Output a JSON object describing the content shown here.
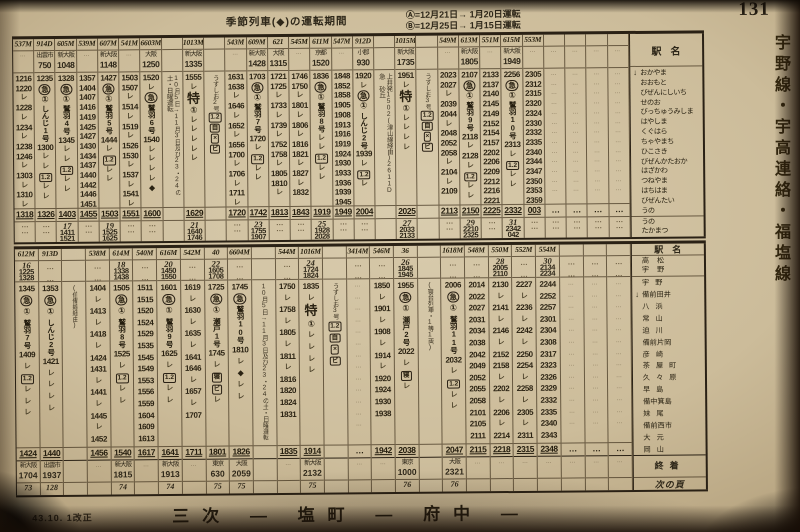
{
  "page": {
    "number": "131",
    "revision": "43.10. 1改正",
    "footer_title": "三次 ― 塩町 ― 府中 ―",
    "next_page_label": "次の頁",
    "side_tab": "宇野線・宇高連絡・福塩線"
  },
  "header": {
    "title": "季節列車(◆)の運転期間",
    "note_a": "Ⓐ=12月21日→ 1月20日運転",
    "note_b": "Ⓑ=12月25日→ 1月15日運転"
  },
  "station_label": "駅名",
  "terminal_label": "終着",
  "top_table": {
    "stations": [
      "おかやま",
      "おおもと",
      "びぜんにしいち",
      "せのお",
      "びっちゅうみしま",
      "はやしま",
      "くぐはら",
      "ちゃやまち",
      "ひこさき",
      "びぜんかたおか",
      "はざかわ",
      "つねやま",
      "はちはま",
      "びぜんたい",
      "うの"
    ],
    "ferry_stations": [
      "うの",
      "たかまつ"
    ],
    "columns": [
      {
        "no": "537M",
        "cells": [
          "1216",
          "1220",
          "L",
          "1228",
          "L",
          "1234",
          "L",
          "1238",
          "1246",
          "L",
          "1303",
          "L",
          "1310",
          "L"
        ],
        "arr": "1318"
      },
      {
        "no": "914D",
        "origin": {
          "st": "出雲市",
          "t": "750"
        },
        "cells": [
          "1235",
          "E",
          "R1",
          "N:しんじ1号",
          "1300",
          "L",
          "L",
          "G",
          "L",
          "L"
        ],
        "arr": "1326"
      },
      {
        "no": "605M",
        "origin": {
          "st": "新大阪",
          "t": "1048"
        },
        "cells": [
          "1328",
          "E",
          "R1",
          "N:鷲羽4号",
          "1345",
          "L",
          "L",
          "G",
          "L",
          "L"
        ],
        "arr": "1403",
        "ferry": {
          "no": "17",
          "dep": "1411",
          "arr": "1521"
        }
      },
      {
        "no": "539M",
        "cells": [
          "1357",
          "1404",
          "1407",
          "1416",
          "1419",
          "1425",
          "1427",
          "1430",
          "1434",
          "1437",
          "1440",
          "1442",
          "1446",
          "1451"
        ],
        "arr": "1455"
      },
      {
        "no": "607M",
        "origin": {
          "st": "新大阪",
          "t": "1148"
        },
        "cells": [
          "1427",
          "E",
          "R1",
          "N:鷲羽5号",
          "1444",
          "L",
          "G",
          "L",
          "L"
        ],
        "arr": "1503",
        "ferry": {
          "no": "19",
          "dep": "1525",
          "arr": "1625"
        }
      },
      {
        "no": "541M",
        "cells": [
          "1503",
          "1507",
          "L",
          "1514",
          "L",
          "1519",
          "L",
          "1526",
          "1530",
          "L",
          "1537",
          "L",
          "1541",
          "L"
        ],
        "arr": "1551"
      },
      {
        "no": "6603M",
        "origin": {
          "st": "大阪",
          "t": "1250"
        },
        "cells": [
          "1520",
          "L",
          "E",
          "N:鷲羽6号",
          "1540",
          "L",
          "L",
          "L",
          "L",
          "D"
        ],
        "arr": "1600"
      },
      {
        "note": "10月5日→11月3日及び23・24の土・日曜運転"
      },
      {
        "no": "1013M",
        "origin": {
          "st": "新大阪",
          "t": "1335"
        },
        "cells": [
          "1555",
          "L",
          "EX",
          "R1",
          "L",
          "L",
          "L",
          "L",
          "L"
        ],
        "arr": "1629",
        "ferry": {
          "no": "21",
          "dep": "1640",
          "arr": "1746"
        }
      },
      {
        "note": "うずしお2号",
        "syms": [
          "G",
          "J",
          "X",
          "B"
        ]
      },
      {
        "no": "543M",
        "cells": [
          "1631",
          "1638",
          "L",
          "1646",
          "L",
          "1652",
          "L",
          "1656",
          "1700",
          "L",
          "1706",
          "L",
          "1711",
          "L"
        ],
        "arr": "1720"
      },
      {
        "no": "609M",
        "origin": {
          "st": "新大阪",
          "t": "1428"
        },
        "cells": [
          "1703",
          "E",
          "R1",
          "N:鷲羽7号",
          "1720",
          "L",
          "G",
          "L",
          "L"
        ],
        "arr": "1742",
        "ferry": {
          "no": "23",
          "dep": "1755",
          "arr": "1907"
        }
      },
      {
        "no": "621",
        "origin": {
          "st": "大阪",
          "t": "1315"
        },
        "cells": [
          "1721",
          "1725",
          "L",
          "1733",
          "L",
          "1739",
          "L",
          "1752",
          "1758",
          "L",
          "1805",
          "1810",
          "L"
        ],
        "arr": "1813"
      },
      {
        "no": "545M",
        "cells": [
          "1746",
          "1750",
          "L",
          "1801",
          "L",
          "1806",
          "L",
          "1816",
          "1821",
          "L",
          "1827",
          "L",
          "1832"
        ],
        "arr": "1843"
      },
      {
        "no": "611M",
        "origin": {
          "st": "京都",
          "t": "1520"
        },
        "cells": [
          "1836",
          "E",
          "R1",
          "N:鷲羽8号",
          "L",
          "L",
          "G",
          "L",
          "L"
        ],
        "arr": "1919",
        "ferry": {
          "no": "25",
          "dep": "1928",
          "arr": "2028"
        }
      },
      {
        "no": "547M",
        "cells": [
          "1848",
          "1852",
          "1858",
          "1905",
          "1908",
          "1913",
          "1916",
          "1919",
          "1924",
          "1930",
          "1933",
          "1936",
          "1939",
          "1945"
        ],
        "arr": "1949"
      },
      {
        "no": "912D",
        "origin": {
          "st": "小郡",
          "t": "930"
        },
        "cells": [
          "1920",
          "L",
          "E",
          "R1",
          "N:しんじ2号",
          "1939",
          "L",
          "G",
          "L"
        ],
        "arr": "2004"
      },
      {
        "note": "上井発1502(津山線経由)2611D 急 砂丘"
      },
      {
        "no": "1015M",
        "origin": {
          "st": "新大阪",
          "t": "1735"
        },
        "cells": [
          "1951",
          "L",
          "EX",
          "R1",
          "L",
          "L",
          "L",
          "L"
        ],
        "arr": "2025",
        "ferry": {
          "no": "27",
          "dep": "2033",
          "arr": "2133"
        }
      },
      {
        "note": "うずしお3号",
        "syms": [
          "G",
          "J",
          "X",
          "B"
        ]
      },
      {
        "no": "549M",
        "cells": [
          "2023",
          "2027",
          "L",
          "2039",
          "2044",
          "L",
          "2048",
          "2052",
          "2058",
          "L",
          "2104",
          "L",
          "2109"
        ],
        "arr": "2113"
      },
      {
        "no": "613M",
        "origin": {
          "st": "新大阪",
          "t": "1805"
        },
        "cells": [
          "2107",
          "E",
          "R1",
          "N:鷲羽9号",
          "2118",
          "L",
          "2128",
          "L",
          "G",
          "L",
          "L"
        ],
        "arr": "2150",
        "ferry": {
          "no": "29",
          "dep": "2210",
          "arr": "2325"
        }
      },
      {
        "no": "551M",
        "cells": [
          "2133",
          "2137",
          "2140",
          "2145",
          "2149",
          "2152",
          "2154",
          "2157",
          "2202",
          "2206",
          "2209",
          "2212",
          "2216",
          "2221"
        ],
        "arr": "2225"
      },
      {
        "no": "615M",
        "origin": {
          "st": "新大阪",
          "t": "1949"
        },
        "cells": [
          "2256",
          "E",
          "R1",
          "N:鷲羽10号",
          "2313",
          "L",
          "G",
          "L",
          "L"
        ],
        "arr": "2332",
        "ferry": {
          "no": "31",
          "dep": "2342",
          "arr": "042"
        }
      },
      {
        "no": "553M",
        "cells": [
          "2305",
          "2312",
          "2315",
          "2320",
          "2324",
          "2330",
          "2332",
          "2335",
          "2340",
          "2344",
          "2347",
          "2350",
          "2353",
          "2359"
        ],
        "arr": "003"
      },
      {
        "blank": true
      },
      {
        "blank": true
      },
      {
        "blank": true
      },
      {
        "blank": true
      }
    ]
  },
  "bottom_table": {
    "ferry_stations": [
      "高松",
      "宇野"
    ],
    "stations": [
      "宇野",
      "備前田井",
      "八浜",
      "常山",
      "迫川",
      "備前片岡",
      "彦崎",
      "茶屋町",
      "久々原",
      "早島",
      "備中箕島",
      "妹尾",
      "備前西市",
      "大元",
      "岡山"
    ],
    "columns": [
      {
        "no": "612M",
        "ferry": {
          "no": "16",
          "dep": "1225",
          "arr": "1328"
        },
        "cells": [
          "1345",
          "E",
          "R1",
          "N:鷲羽7号",
          "1409",
          "L",
          "G",
          "L",
          "L",
          "L"
        ],
        "arr": "1424",
        "term": {
          "st": "新大阪",
          "t": "1704"
        },
        "page": "73"
      },
      {
        "no": "913D",
        "cells": [
          "1353",
          "E",
          "R1",
          "N:しんじ2号",
          "1421",
          "L",
          "L",
          "L",
          "L"
        ],
        "arr": "1440",
        "term": {
          "st": "出雲市",
          "t": "1937"
        },
        "page": "128"
      },
      {
        "note": "(伯備線経由)"
      },
      {
        "no": "538M",
        "cells": [
          "1404",
          "L",
          "1413",
          "L",
          "1418",
          "L",
          "1424",
          "1431",
          "L",
          "1441",
          "L",
          "1445",
          "L",
          "1452"
        ],
        "arr": "1456"
      },
      {
        "no": "614M",
        "ferry": {
          "no": "18",
          "dep": "1338",
          "arr": "1438"
        },
        "cells": [
          "1505",
          "E",
          "R1",
          "N:鷲羽8号",
          "1525",
          "L",
          "G",
          "L",
          "L"
        ],
        "arr": "1540",
        "term": {
          "st": "新大阪",
          "t": "1815"
        },
        "page": "74"
      },
      {
        "no": "540M",
        "cells": [
          "1511",
          "1515",
          "1520",
          "1524",
          "1529",
          "1535",
          "1545",
          "1549",
          "1553",
          "1556",
          "1559",
          "1604",
          "1609",
          "1613"
        ],
        "arr": "1617"
      },
      {
        "no": "616M",
        "ferry": {
          "no": "20",
          "dep": "1450",
          "arr": "1550"
        },
        "cells": [
          "1601",
          "E",
          "R1",
          "N:鷲羽9号",
          "1625",
          "L",
          "G",
          "L",
          "L"
        ],
        "arr": "1641",
        "term": {
          "st": "新大阪",
          "t": "1913"
        },
        "page": "74"
      },
      {
        "no": "542M",
        "cells": [
          "1619",
          "L",
          "1630",
          "L",
          "1635",
          "L",
          "1641",
          "1646",
          "L",
          "1657",
          "L",
          "1707"
        ],
        "arr": "1711"
      },
      {
        "no": "40",
        "ferry": {
          "no": "22",
          "dep": "1605",
          "arr": "1708"
        },
        "cells": [
          "1725",
          "E",
          "R1",
          "N:瀬戸1号",
          "1745",
          "L",
          "S",
          "B",
          "L"
        ],
        "arr": "1801",
        "term": {
          "st": "東京",
          "t": "630"
        },
        "page": "75"
      },
      {
        "no": "6604M",
        "cells": [
          "1745",
          "E",
          "N:鷲羽10号",
          "1810",
          "L",
          "D",
          "L",
          "L"
        ],
        "arr": "1826",
        "term": {
          "st": "大阪",
          "t": "2059"
        },
        "page": "75"
      },
      {
        "note": "10月5日→11月3日及び23・24の土・日曜運転"
      },
      {
        "no": "544M",
        "cells": [
          "1750",
          "L",
          "1758",
          "L",
          "1805",
          "L",
          "1811",
          "L",
          "1816",
          "1820",
          "1824",
          "1831"
        ],
        "arr": "1835"
      },
      {
        "no": "1016M",
        "ferry": {
          "no": "24",
          "dep": "1724",
          "arr": "1824"
        },
        "cells": [
          "1835",
          "L",
          "EX",
          "R1",
          "L",
          "L",
          "L",
          "L"
        ],
        "arr": "1914",
        "term": {
          "st": "新大阪",
          "t": "2132"
        },
        "page": "75"
      },
      {
        "note": "うずしお3号",
        "syms": [
          "G",
          "J",
          "X",
          "B"
        ]
      },
      {
        "no": "3414M",
        "blank": true
      },
      {
        "no": "546M",
        "cells": [
          "1850",
          "L",
          "1901",
          "L",
          "1908",
          "L",
          "1914",
          "L",
          "1920",
          "1924",
          "1930",
          "1938"
        ],
        "arr": "1942"
      },
      {
        "no": "36",
        "ferry": {
          "no": "26",
          "dep": "1845",
          "arr": "1945"
        },
        "cells": [
          "1955",
          "E",
          "R1",
          "N:瀬戸2号",
          "2022",
          "L",
          "S",
          "L"
        ],
        "arr": "2038",
        "term": {
          "st": "東京",
          "t": "1000"
        },
        "page": "76"
      },
      {
        "note": "(寝台列車・1等1両)"
      },
      {
        "no": "1618M",
        "cells": [
          "2006",
          "E",
          "R1",
          "N:鷲羽11号",
          "2032",
          "L",
          "G",
          "L",
          "L"
        ],
        "arr": "2047",
        "term": {
          "st": "大阪",
          "t": "2321"
        },
        "page": "76"
      },
      {
        "no": "548M",
        "cells": [
          "2014",
          "2022",
          "2027",
          "2031",
          "2034",
          "2038",
          "2042",
          "2049",
          "2052",
          "2055",
          "2058",
          "2101",
          "2105",
          "2111"
        ],
        "arr": "2115"
      },
      {
        "no": "550M",
        "ferry": {
          "no": "28",
          "dep": "2005",
          "arr": "2110"
        },
        "cells": [
          "2130",
          "L",
          "2141",
          "L",
          "2146",
          "L",
          "2152",
          "2158",
          "L",
          "2202",
          "L",
          "2206",
          "L",
          "2214"
        ],
        "arr": "2218"
      },
      {
        "no": "552M",
        "cells": [
          "2227",
          "L",
          "2236",
          "L",
          "2242",
          "L",
          "2250",
          "2254",
          "L",
          "2258",
          "L",
          "2305",
          "L",
          "2311"
        ],
        "arr": "2315"
      },
      {
        "no": "554M",
        "ferry": {
          "no": "30",
          "dep": "2134",
          "arr": "2234"
        },
        "cells": [
          "2244",
          "2252",
          "2257",
          "2301",
          "2304",
          "2308",
          "2317",
          "2323",
          "2326",
          "2329",
          "2332",
          "2335",
          "2340",
          "2343"
        ],
        "arr": "2348"
      },
      {
        "blank": true
      },
      {
        "blank": true
      },
      {
        "blank": true
      }
    ]
  }
}
